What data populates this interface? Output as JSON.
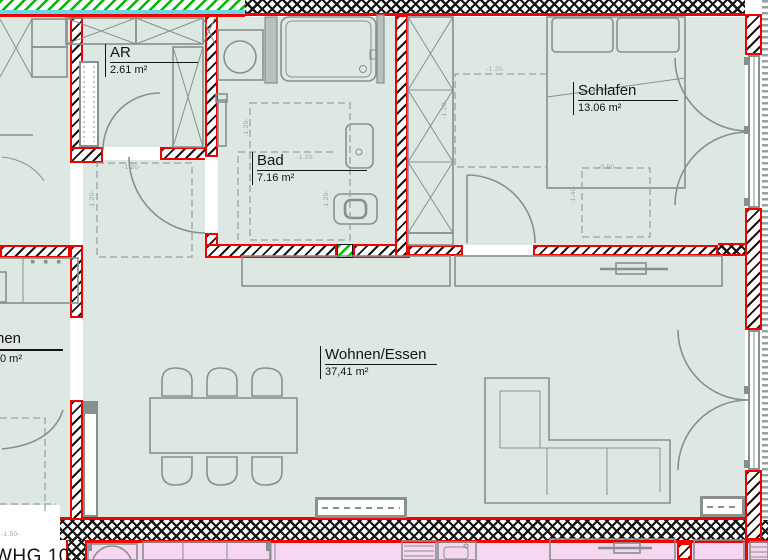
{
  "plan_type": "apartment floor plan",
  "rooms": {
    "ar": {
      "name": "AR",
      "area": "2.61 m²"
    },
    "bad": {
      "name": "Bad",
      "area": "7.16 m²"
    },
    "schlafen": {
      "name": "Schlafen",
      "area": "13.06 m²"
    },
    "wohnen": {
      "name": "Wohnen/Essen",
      "area": "37,41 m²"
    },
    "neighbor": {
      "name": "nen",
      "area": "0 m²"
    }
  },
  "apartment": {
    "label": "WHG 10"
  },
  "dimensions": {
    "h120": "-1.20-",
    "h090": "-0.90-",
    "h140": "-1.40-",
    "h150": "-1.50-"
  },
  "colors": {
    "wall_red": "#f30000",
    "floor_main": "#dde8e2",
    "floor_lower_flat": "#f5d7f1",
    "insulation_green": "#00b800",
    "insulation_cyan": "#63d8e6",
    "furniture_gray": "#869090"
  }
}
